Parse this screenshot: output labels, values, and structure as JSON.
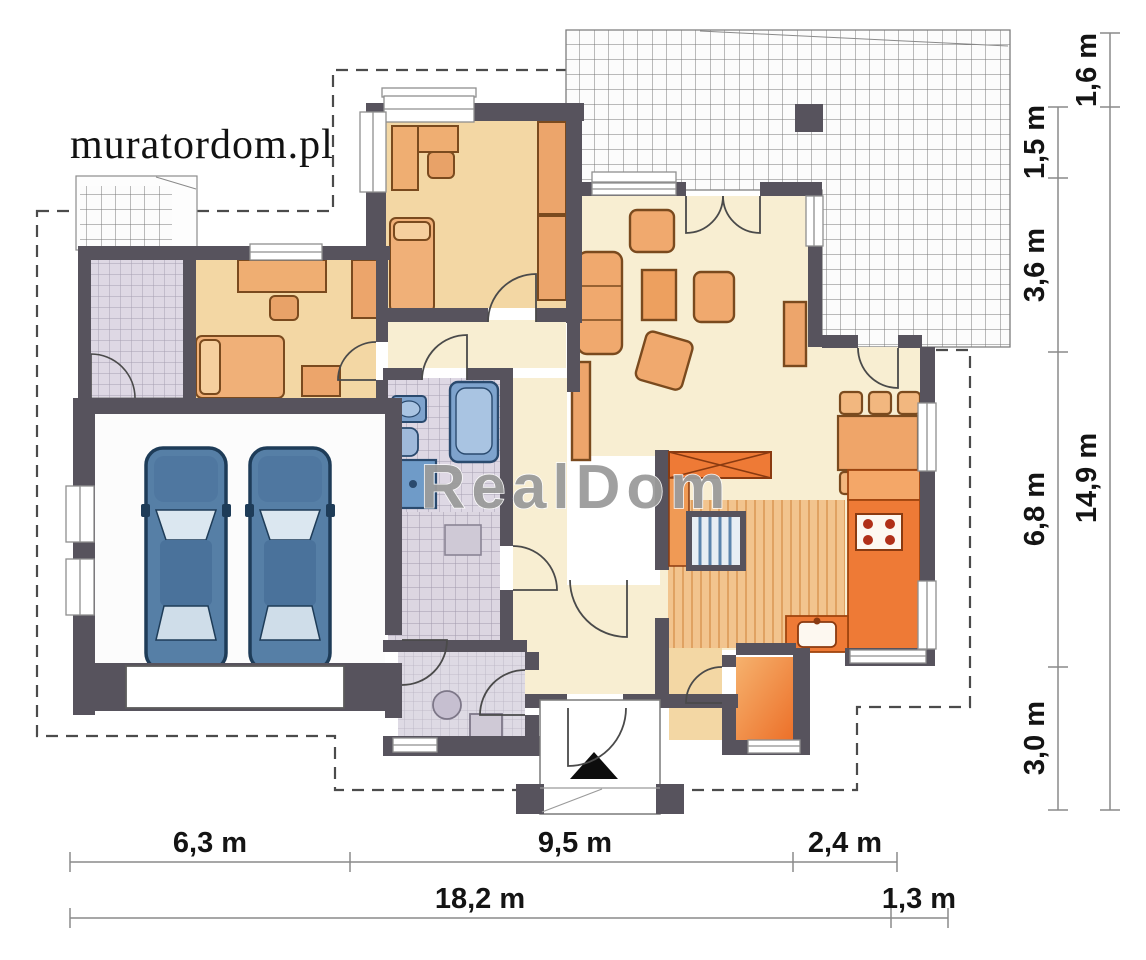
{
  "watermarks": {
    "site": "muratordom.pl",
    "brand": "RealDom"
  },
  "dimensions": {
    "bottom_primary": [
      "6,3 m",
      "9,5 m",
      "2,4 m"
    ],
    "bottom_total": [
      "18,2 m",
      "1,3 m"
    ],
    "right_primary": [
      "1,5 m",
      "3,6 m",
      "6,8 m",
      "3,0 m"
    ],
    "right_total": [
      "1,6 m",
      "14,9 m"
    ]
  },
  "colors": {
    "wall": "#57535d",
    "floor_bedroom": "#f3d7a4",
    "floor_living": "#f8eed2",
    "floor_tile": "#dcd6e1",
    "kitchen_accent": "#ee7a36",
    "furniture": "#efa96e",
    "car_blue": "#567fa6",
    "bathroom_blue": "#7ea3cd",
    "watermark_gray": "#9b9b9b",
    "dimension_text": "#141414"
  }
}
